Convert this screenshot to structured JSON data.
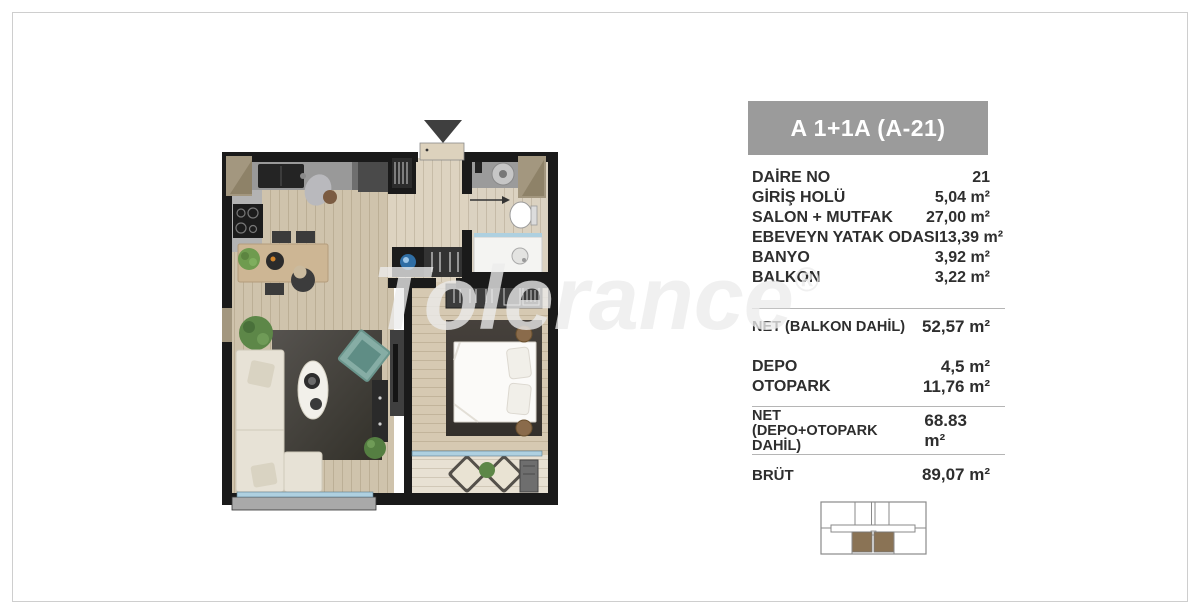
{
  "panel": {
    "title": "A 1+1A  (A-21)",
    "rooms": [
      {
        "label": "DAİRE NO",
        "value": "21"
      },
      {
        "label": "GİRİŞ HOLÜ",
        "value": "5,04 m²"
      },
      {
        "label": "SALON + MUTFAK",
        "value": "27,00 m²"
      },
      {
        "label": "EBEVEYN YATAK ODASI",
        "value": "13,39 m²"
      },
      {
        "label": "BANYO",
        "value": "3,92 m²"
      },
      {
        "label": "BALKON",
        "value": "3,22 m²"
      }
    ],
    "net_balkon": {
      "label": "NET (BALKON DAHİL)",
      "value": "52,57 m²"
    },
    "extras": [
      {
        "label": "DEPO",
        "value": "4,5 m²"
      },
      {
        "label": "OTOPARK",
        "value": "11,76 m²"
      }
    ],
    "net_total": {
      "line1": "NET",
      "line2": "(DEPO+OTOPARK DAHİL)",
      "value": "68.83 m²"
    },
    "brut": {
      "label": "BRÜT",
      "value": "89,07 m²"
    }
  },
  "watermark": {
    "text": "Tolerance",
    "reg": "®"
  },
  "colors": {
    "header_bg": "#9b9b9b",
    "unit_highlight": "#8a7355",
    "glass_blue": "#aed0e0",
    "wall": "#1a1a1a",
    "text": "#2e2e2e"
  }
}
